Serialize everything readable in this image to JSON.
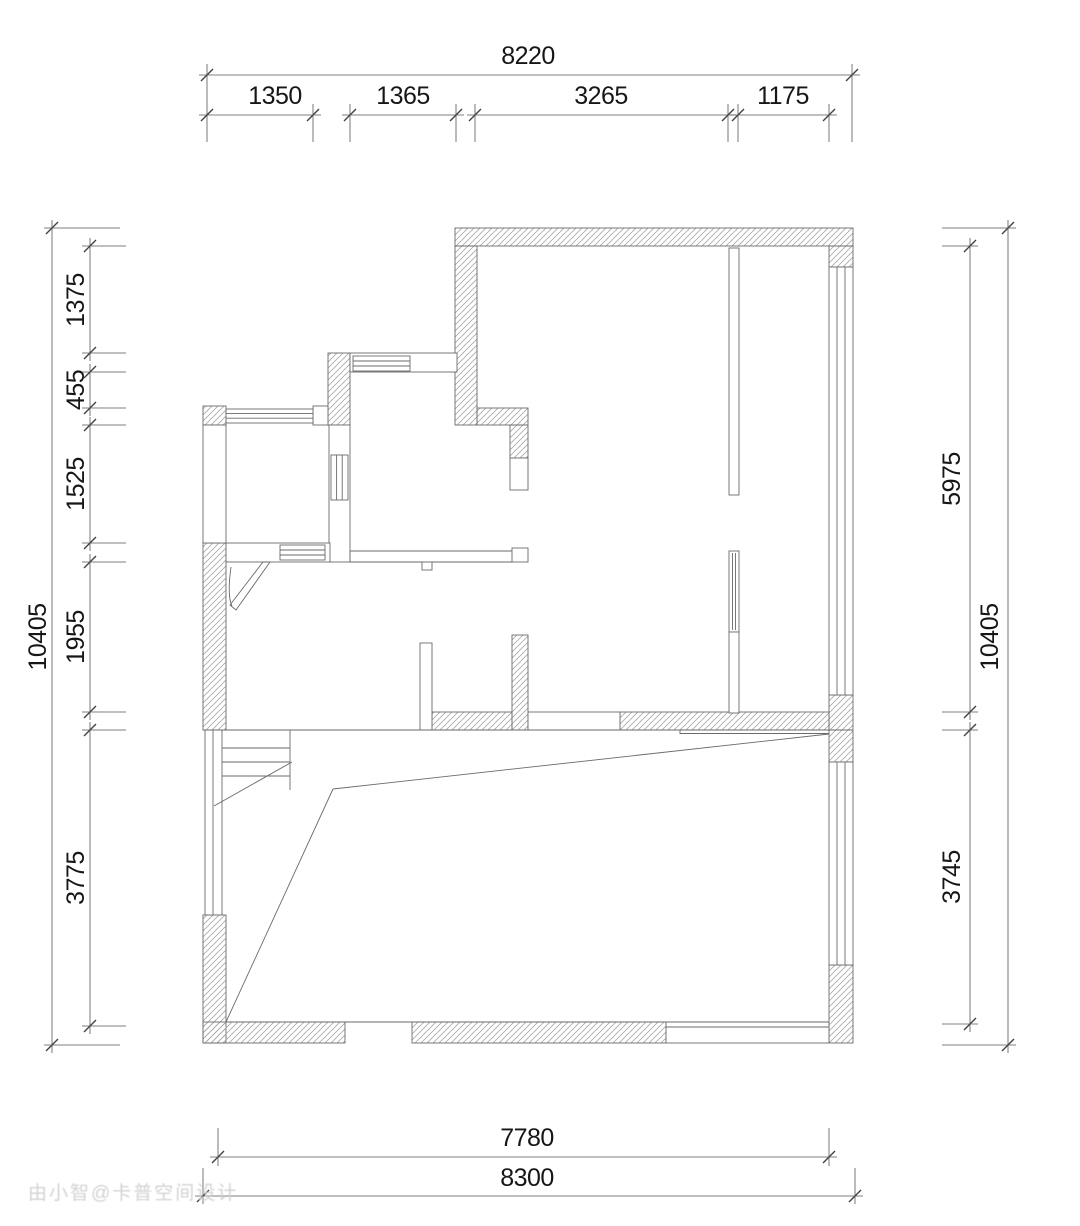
{
  "dimensions": {
    "top": {
      "overall": "8220",
      "segments": [
        "1350",
        "1365",
        "3265",
        "1175"
      ]
    },
    "left": {
      "overall": "10405",
      "segments": [
        "1375",
        "455",
        "1525",
        "1955",
        "3775"
      ]
    },
    "right": {
      "overall": "10405",
      "inner_segments": [
        "5975",
        "3745"
      ]
    },
    "bottom": {
      "inner": "7780",
      "outer": "8300"
    }
  },
  "watermark": {
    "text": "由小智@卡普空间设计"
  },
  "colors": {
    "background": "#ffffff",
    "wall_line": "#6a6a6a",
    "hatch": "#a8a8a8",
    "dim_text": "#161616",
    "watermark": "#d2d2d2"
  }
}
